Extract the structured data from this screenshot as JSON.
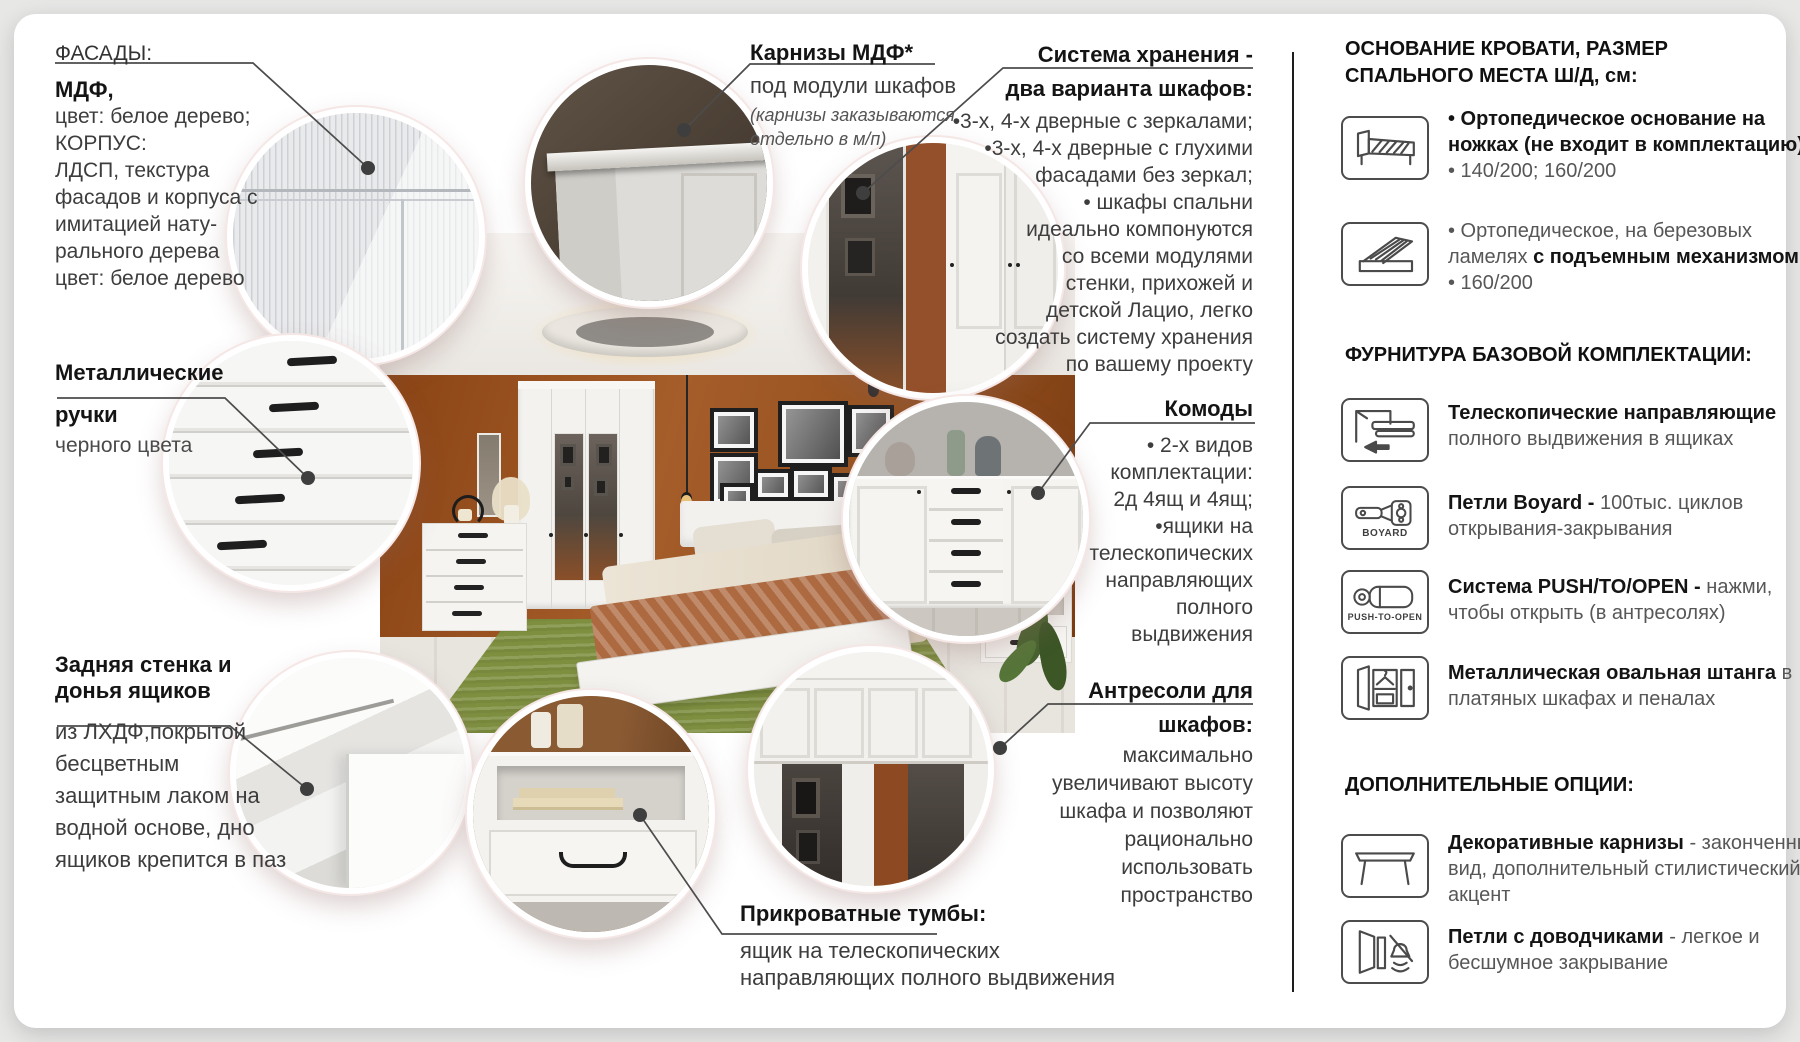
{
  "colors": {
    "wall_accent": "#9a5426",
    "rug_green": "#7e9040",
    "line": "#4c4c4c",
    "ring": "#f5e7e5"
  },
  "callouts": {
    "facade": {
      "label": "ФАСАДЫ:",
      "title": "МДФ,",
      "lines": [
        "цвет: белое дерево;",
        "КОРПУС:",
        "ЛДСП, текстура",
        "фасадов и корпуса с",
        "имитацией нату-",
        "рального дерева",
        "цвет: белое дерево"
      ]
    },
    "handles": {
      "title1": "Металлические",
      "title2": "ручки",
      "body": "черного цвета"
    },
    "backwall": {
      "title1": "Задняя стенка и",
      "title2": "донья ящиков",
      "lines": [
        "из ЛХДФ,покрытой",
        "бесцветным",
        "защитным лаком на",
        "водной основе, дно",
        "ящиков крепится в паз"
      ]
    },
    "cornice": {
      "title": "Карнизы МДФ*",
      "subtitle": "под модули шкафов",
      "note1": "(карнизы заказываются",
      "note2": "отдельно в м/п)"
    },
    "storage": {
      "title1": "Система хранения -",
      "title2": "два варианта шкафов:",
      "lines": [
        "•3-х, 4-х дверные с зеркалами;",
        "•3-х, 4-х дверные с глухими",
        "фасадами без зеркал;",
        "• шкафы спальни",
        "идеально компонуются",
        "со всеми модулями",
        "стенки, прихожей и",
        "детской Лацио, легко",
        "создать систему хранения",
        "по вашему проекту"
      ]
    },
    "komod": {
      "title": "Комоды",
      "lines": [
        "• 2-х видов",
        "комплектации:",
        "2д 4ящ и 4ящ;",
        "•ящики на",
        "телескопических",
        "направляющих",
        "полного",
        "выдвижения"
      ]
    },
    "antresol": {
      "title1": "Антресоли для",
      "title2": "шкафов:",
      "lines": [
        "максимально",
        "увеличивают высоту",
        "шкафа и позволяют",
        "рационально",
        "использовать",
        "пространство"
      ]
    },
    "tumba": {
      "title": "Прикроватные тумбы:",
      "lines": [
        "ящик на телескопических",
        "направляющих полного выдвижения"
      ]
    }
  },
  "panel": {
    "bed_title1": "ОСНОВАНИЕ КРОВАТИ, РАЗМЕР",
    "bed_title2": "СПАЛЬНОГО МЕСТА Ш/Д, см:",
    "bed_items": [
      {
        "icon": "bed-orthopedic-icon",
        "line1": "• Ортопедическое основание на",
        "line2": "ножках (не входит в комплектацию)",
        "line3": "• 140/200; 160/200"
      },
      {
        "icon": "bed-lift-icon",
        "line1": "• Ортопедическое, на березовых",
        "line2a": "ламелях  ",
        "line2b": "с подъемным механизмом;",
        "line3": "• 160/200"
      }
    ],
    "fittings_title": "ФУРНИТУРА БАЗОВОЙ КОМПЛЕКТАЦИИ:",
    "fittings": [
      {
        "icon": "telescopic-rails-icon",
        "bold": "Телескопические направляющие",
        "line2": "полного выдвижения в ящиках"
      },
      {
        "icon": "boyard-hinge-icon",
        "icon_label": "BOYARD",
        "bold": "Петли Boyard -",
        "rest": " 100тыс. циклов",
        "line2": "открывания-закрывания"
      },
      {
        "icon": "push-to-open-icon",
        "icon_label": "PUSH-TO-OPEN",
        "bold": "Система PUSH/TO/OPEN -",
        "rest": " нажми,",
        "line2": "чтобы открыть (в антресолях)"
      },
      {
        "icon": "oval-rod-icon",
        "bold": "Металлическая овальная штанга",
        "rest": " в",
        "line2": "платяных шкафах и пеналах"
      }
    ],
    "options_title": "ДОПОЛНИТЕЛЬНЫЕ ОПЦИИ:",
    "options": [
      {
        "icon": "decorative-cornice-icon",
        "bold": "Декоративные карнизы",
        "rest": " - законченный",
        "line2": "вид, дополнительный стилистический",
        "line3": "акцент"
      },
      {
        "icon": "soft-close-hinge-icon",
        "bold": "Петли с доводчиками",
        "rest": " - легкое и",
        "line2": "бесшумное закрывание"
      }
    ]
  }
}
